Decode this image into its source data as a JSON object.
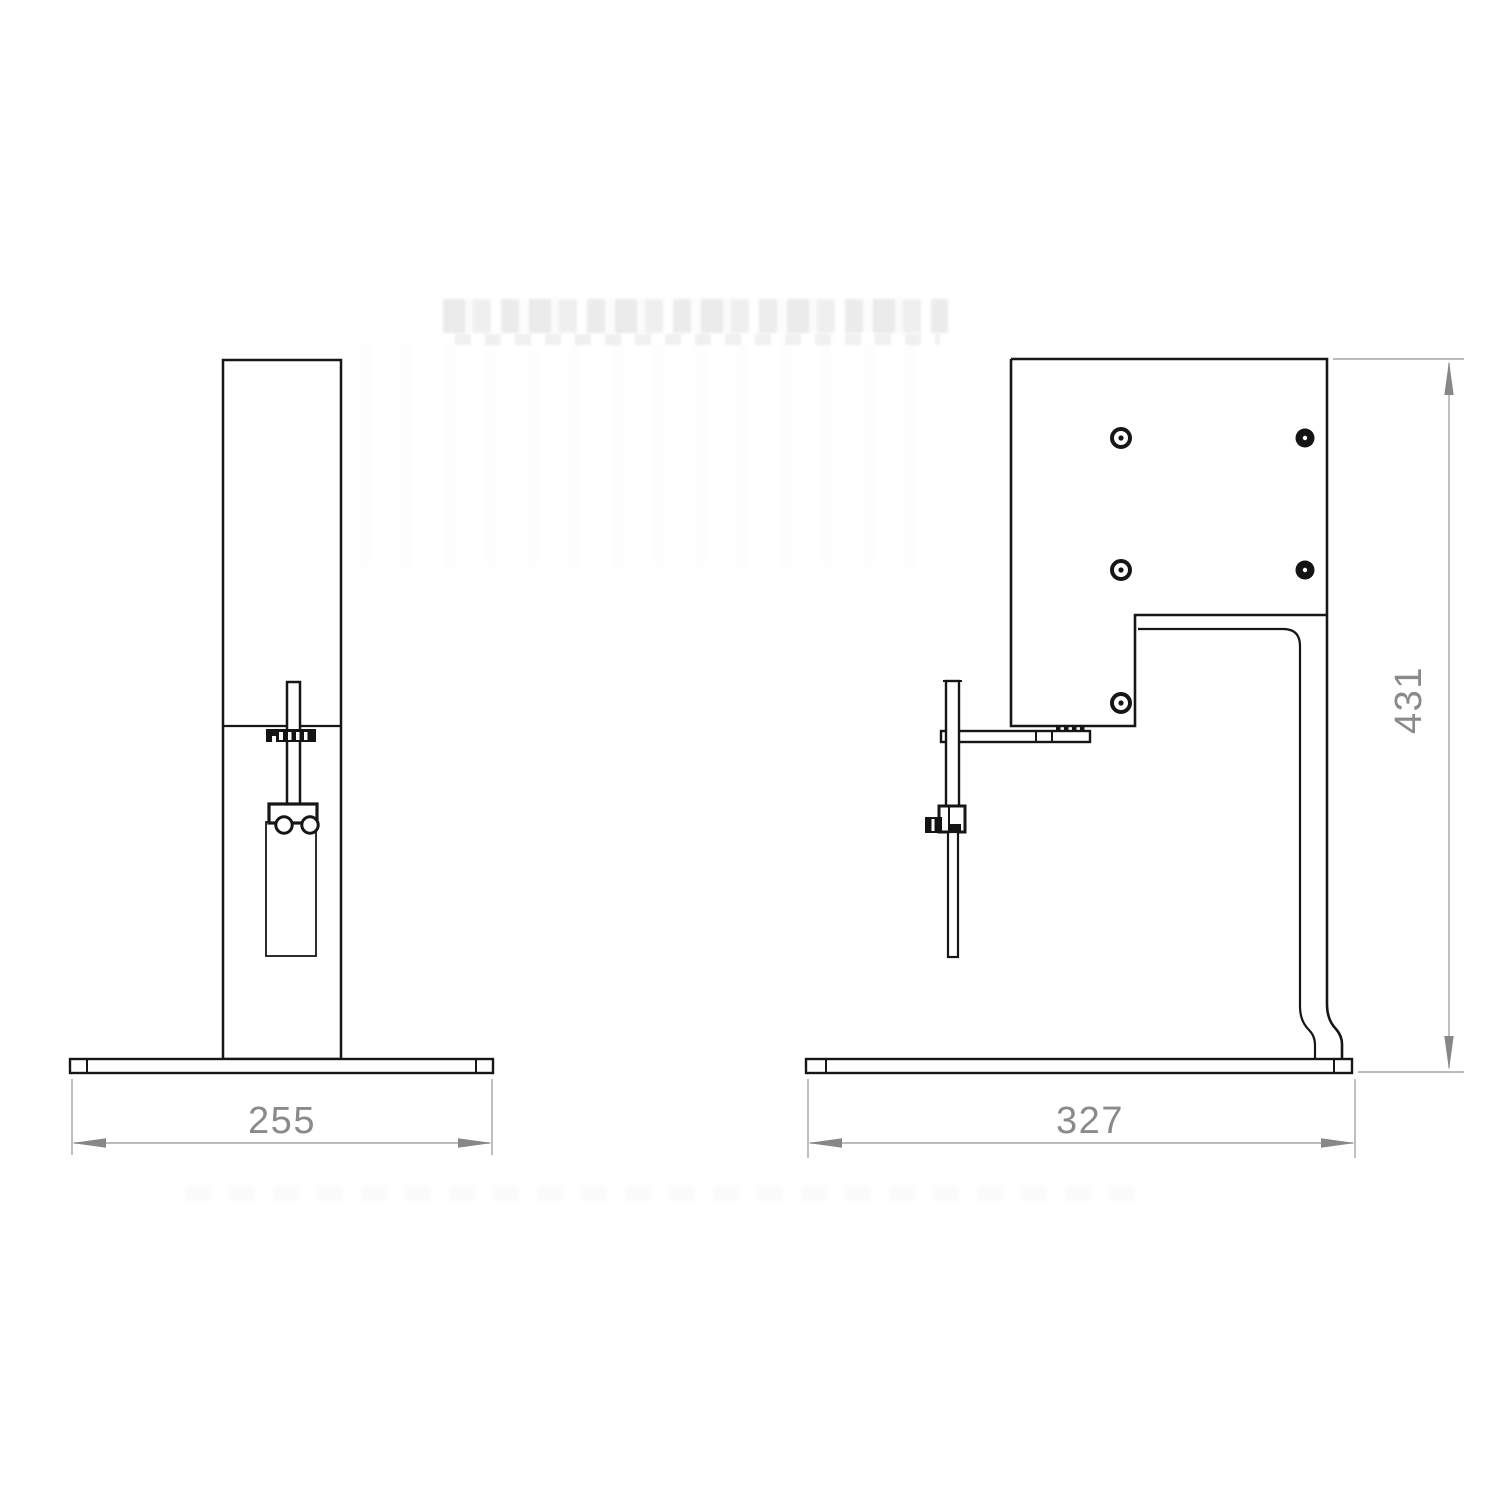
{
  "drawing": {
    "type": "technical-drawing-two-views",
    "colors": {
      "background": "#ffffff",
      "outline": "#161616",
      "dimension_lines": "#a5a5a5",
      "dimension_text": "#8a8a8a"
    },
    "dimensions": {
      "front_width": "255",
      "side_width": "327",
      "side_height": "431"
    }
  }
}
